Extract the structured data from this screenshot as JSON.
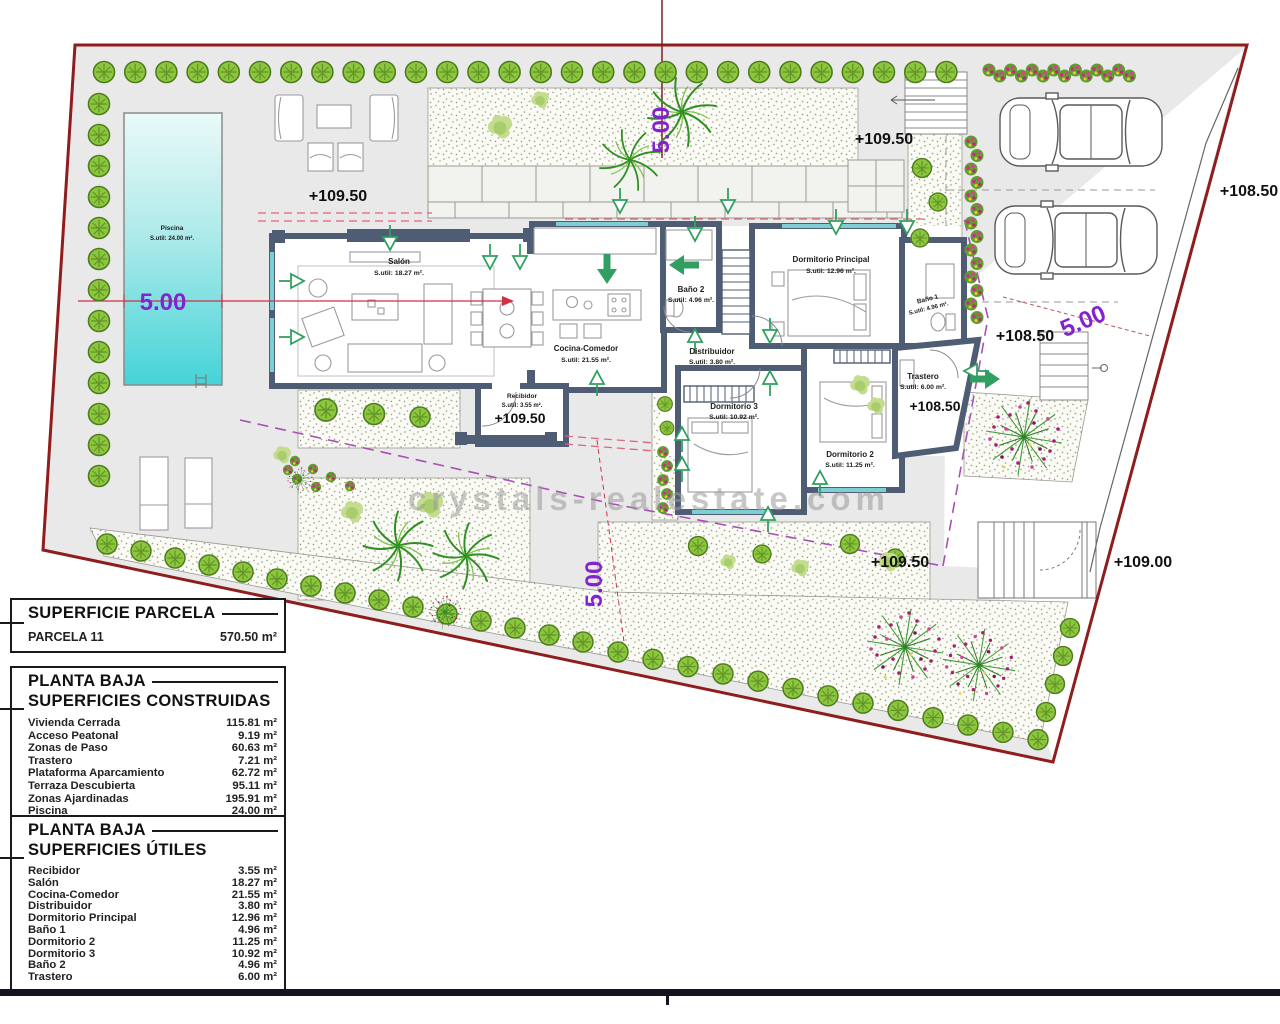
{
  "plan": {
    "watermark": "crystals-realestate.com",
    "elevations": {
      "high": "+109.50",
      "mid": "+108.50",
      "low": "+109.00"
    },
    "dimension": "5.00",
    "pool": {
      "name": "Piscina",
      "area": "S.util: 24.00 m²."
    },
    "rooms": {
      "salon": {
        "name": "Salón",
        "area": "S.util: 18.27 m²."
      },
      "cocina": {
        "name": "Cocina-Comedor",
        "area": "S.util: 21.55 m²."
      },
      "recibidor": {
        "name": "Recibidor",
        "area": "S.util: 3.55 m²."
      },
      "banyo2": {
        "name": "Baño 2",
        "area": "S.util: 4.96 m²."
      },
      "distribuidor": {
        "name": "Distribuidor",
        "area": "S.util: 3.80 m²."
      },
      "dormPrincipal": {
        "name": "Dormitorio Principal",
        "area": "S.util: 12.96 m²."
      },
      "banyo1": {
        "name": "Baño 1",
        "area": "S.util: 4.96 m²."
      },
      "dorm3": {
        "name": "Dormitorio 3",
        "area": "S.util: 10.92 m²."
      },
      "dorm2": {
        "name": "Dormitorio 2",
        "area": "S.util: 11.25 m²."
      },
      "trastero": {
        "name": "Trastero",
        "area": "S.util: 6.00 m²."
      }
    }
  },
  "tables": {
    "parcela": {
      "title": "SUPERFICIE PARCELA",
      "rows": [
        {
          "label": "PARCELA 11",
          "value": "570.50 m²"
        }
      ]
    },
    "construidas": {
      "title1": "PLANTA BAJA",
      "title2": "SUPERFICIES CONSTRUIDAS",
      "rows": [
        {
          "label": "Vivienda Cerrada",
          "value": "115.81 m²"
        },
        {
          "label": "Acceso Peatonal",
          "value": "9.19 m²"
        },
        {
          "label": "Zonas de Paso",
          "value": "60.63 m²"
        },
        {
          "label": "Trastero",
          "value": "7.21 m²"
        },
        {
          "label": "Plataforma Aparcamiento",
          "value": "62.72 m²"
        },
        {
          "label": "Terraza Descubierta",
          "value": "95.11 m²"
        },
        {
          "label": "Zonas Ajardinadas",
          "value": "195.91 m²"
        },
        {
          "label": "Piscina",
          "value": "24.00 m²"
        }
      ]
    },
    "utiles": {
      "title1": "PLANTA BAJA",
      "title2": "SUPERFICIES ÚTILES",
      "rows": [
        {
          "label": "Recibidor",
          "value": "3.55 m²"
        },
        {
          "label": "Salón",
          "value": "18.27 m²"
        },
        {
          "label": "Cocina-Comedor",
          "value": "21.55 m²"
        },
        {
          "label": "Distribuidor",
          "value": "3.80 m²"
        },
        {
          "label": "Dormitorio Principal",
          "value": "12.96 m²"
        },
        {
          "label": "Baño 1",
          "value": "4.96 m²"
        },
        {
          "label": "Dormitorio 2",
          "value": "11.25 m²"
        },
        {
          "label": "Dormitorio 3",
          "value": "10.92 m²"
        },
        {
          "label": "Baño 2",
          "value": "4.96 m²"
        },
        {
          "label": "Trastero",
          "value": "6.00 m²"
        }
      ]
    }
  },
  "colors": {
    "boundary": "#8f1d1d",
    "wall": "#4e5d73",
    "pool": "#4fd6d9",
    "dimension_purple": "#8323cf",
    "garden_green": "#8cc63e",
    "arrow_green": "#2fa05f"
  }
}
